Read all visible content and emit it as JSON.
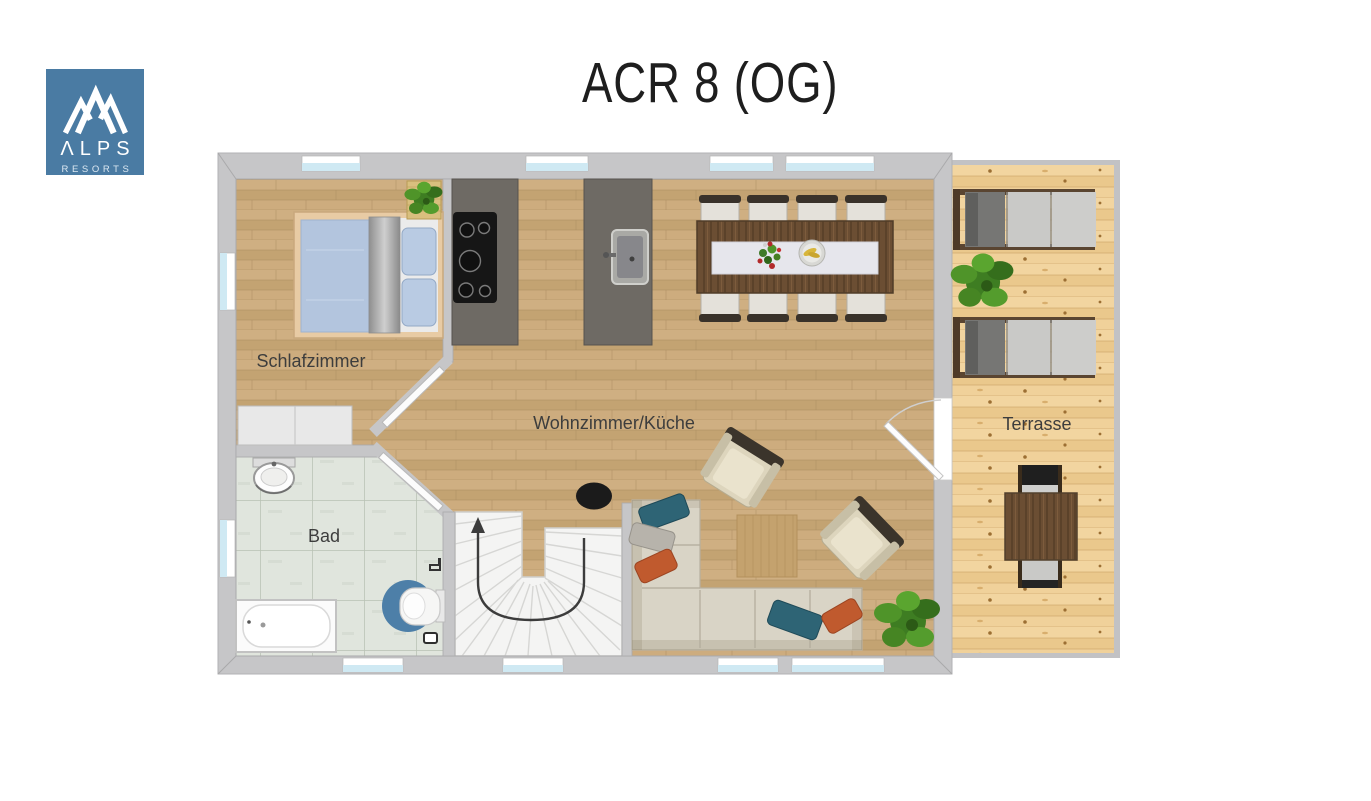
{
  "header": {
    "title": "ACR 8 (OG)"
  },
  "logo": {
    "name": "ΛLPS",
    "subtitle": "RESORTS",
    "icon": "mountain-peaks-icon",
    "bg_color": "#4a7ba3"
  },
  "floor_plan": {
    "rooms": [
      {
        "id": "schlafzimmer",
        "label": "Schlafzimmer",
        "furniture": [
          "double-bed-with-blue-duvet",
          "two-pillows",
          "wardrobe",
          "potted-plant-on-mat"
        ]
      },
      {
        "id": "bad",
        "label": "Bad",
        "furniture": [
          "washbasin",
          "bathtub",
          "wall-toilet-with-blue-round-rug"
        ]
      },
      {
        "id": "wohnzimmer-kueche",
        "label": "Wohnzimmer/Küche",
        "furniture": [
          "counter-with-cooktop",
          "counter-with-sink",
          "dining-table-with-runner",
          "eight-dining-chairs",
          "corner-sofa-with-pillows",
          "armchair",
          "armchair",
          "square-rug",
          "black-side-table",
          "potted-plant",
          "winder-staircase-with-up-arrow"
        ]
      },
      {
        "id": "terrasse",
        "label": "Terrasse",
        "furniture": [
          "sun-lounger",
          "sun-lounger",
          "potted-plant",
          "outdoor-dining-table",
          "outdoor-chair",
          "outdoor-chair"
        ]
      }
    ],
    "colors": {
      "wall": "#c6c6c8",
      "wood_floor": "#c9aa7b",
      "terrace_wood": "#eecd95",
      "bath_tile": "#e0e5dd",
      "counter_gray": "#6e6a64",
      "dark_wood": "#6b4e33",
      "window_glass": "#cfe9f3",
      "sofa_cream": "#d9d4c6",
      "pillow_teal": "#2e6475",
      "pillow_orange": "#c05a2e",
      "bed_blue": "#b3c5de",
      "toilet_rug_blue": "#4d7fa8",
      "plant_green": "#4c8a2e",
      "stairs_white": "#f4f4f3",
      "label_text": "#3d3d3d"
    }
  }
}
